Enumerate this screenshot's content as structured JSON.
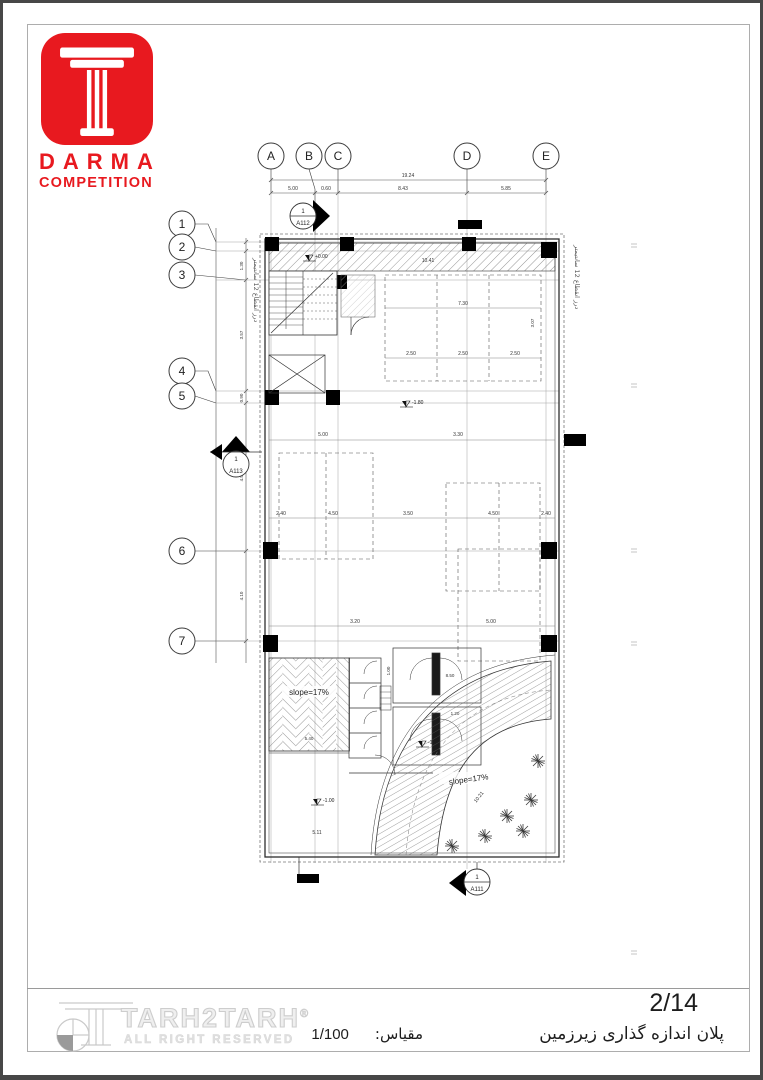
{
  "header": {
    "brand": "DARMA",
    "subtitle": "COMPETITION",
    "brand_color": "#e8191f"
  },
  "plan": {
    "grid_cols": [
      "A",
      "B",
      "C",
      "D",
      "E"
    ],
    "grid_rows": [
      "1",
      "2",
      "3",
      "4",
      "5",
      "6",
      "7"
    ],
    "markers": {
      "a112": {
        "num": "1",
        "sheet": "A112"
      },
      "a113": {
        "num": "1",
        "sheet": "A113"
      },
      "a111": {
        "num": "1",
        "sheet": "A111"
      }
    },
    "joint_note": "درز انقطاع 12 سانتیمتر",
    "slope_label": "slope=17%",
    "ramp_length": "10.21",
    "levels": {
      "ground": "+0.00",
      "mid": "-1.80",
      "lower": "-1.80",
      "yard": "-1.00"
    },
    "dims": {
      "top_overall": "19.24",
      "top": [
        "5.00",
        "0.60",
        "8.43",
        "5.85"
      ],
      "left": [
        "1.30",
        "3.57",
        "0.90",
        "4.50",
        "4.10"
      ],
      "band": "10.41",
      "parking_top": [
        "7.30",
        "2.50",
        "2.50",
        "2.50",
        "3.07"
      ],
      "mid_a": [
        "5.00",
        "3.30"
      ],
      "mid_b": [
        "2.40",
        "4.50",
        "3.50",
        "4.50",
        "2.40"
      ],
      "low": [
        "3.20",
        "5.00",
        "5.11"
      ],
      "wc": [
        "8.50",
        "1.20",
        "1.00",
        "5.40"
      ]
    }
  },
  "footer": {
    "company": "TARH2TARH",
    "registered": "®",
    "rights": "ALL RIGHT RESERVED",
    "scale_label": "مقیاس:",
    "scale_value": "1/100",
    "sheet_number": "2/14",
    "sheet_title": "پلان اندازه گذاری زیرزمین"
  }
}
